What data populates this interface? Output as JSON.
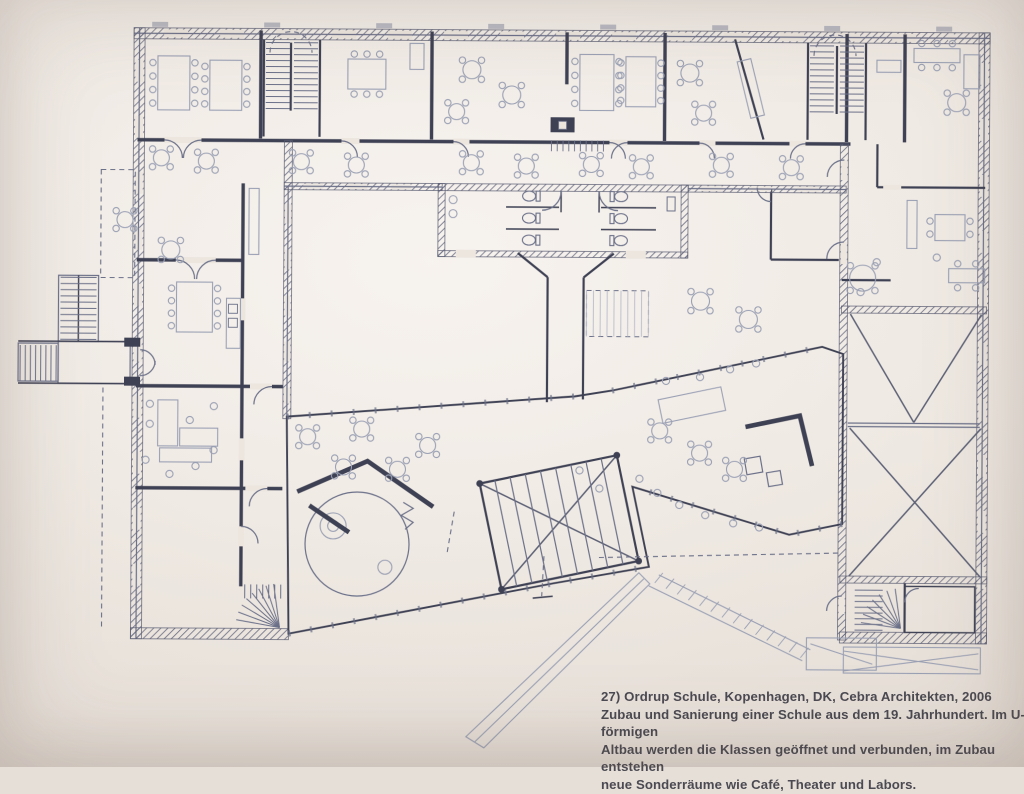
{
  "page": {
    "paper_color": "#ece6df",
    "ink_color": "#3e4154",
    "ink_mid": "#6b7089",
    "ink_light": "#9aa0b4",
    "caption_color": "#4b4a52"
  },
  "caption": {
    "lines": [
      "27) Ordrup Schule, Kopenhagen, DK, Cebra Architekten, 2006",
      "Zubau und Sanierung einer Schule aus dem 19. Jahrhundert. Im U-förmigen",
      "Altbau werden die Klassen geöffnet und verbunden, im Zubau entstehen",
      "neue Sonderräume wie Café, Theater und Labors."
    ]
  },
  "figure": {
    "number": "27",
    "project": "Ordrup Schule",
    "location": "Kopenhagen, DK",
    "architect": "Cebra Architekten",
    "year": "2006"
  }
}
